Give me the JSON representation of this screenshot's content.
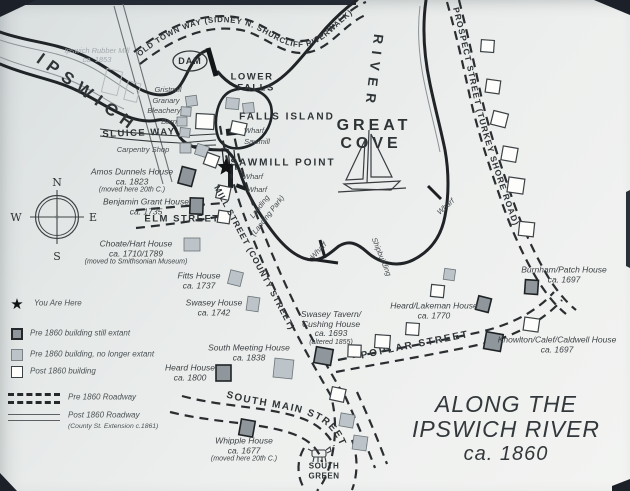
{
  "title": {
    "line1": "ALONG THE",
    "line2": "IPSWICH RIVER",
    "line3": "ca. 1860"
  },
  "waterways": {
    "river_name": "IPSWICH",
    "river_word": "RIVER",
    "cove1": "GREAT",
    "cove2": "COVE",
    "dam": "DAM",
    "falls1": "LOWER",
    "falls2": "FALLS",
    "falls_island": "FALLS ISLAND",
    "sawmill_point": "SAWMILL POINT",
    "sluice_way": "SLUICE WAY"
  },
  "streets": {
    "old_town_way": "OLD TOWN WAY (SIDNEY N. SHURCLIFF RIVERWALK)",
    "prospect": "PROSPECT STREET (TURKEY SHORE ROAD)",
    "elm": "ELM STREET",
    "mill": "MILL STREET (COUNTY STREET)",
    "poplar": "POPLAR STREET",
    "south_main": "SOUTH MAIN STREET",
    "south_green1": "SOUTH",
    "south_green2": "GREEN"
  },
  "sites": {
    "wharf": "Wharf",
    "sawmill": "Sawmill",
    "shipbuilding": "Shipbuilding",
    "landing1": "Landing",
    "landing2": "(Landing Park)",
    "gristmill": "Gristmill",
    "granary": "Granary",
    "bleachery": "Bleachery",
    "barn": "Barn",
    "carpentry_shop": "Carpentry Shop",
    "rubber_mill1": "Ipswich Rubber Mill",
    "rubber_mill2": "ca. 1853"
  },
  "houses": [
    {
      "name": "Amos Dunnels House",
      "date": "ca. 1823",
      "note": "(moved here 20th C.)"
    },
    {
      "name": "Benjamin Grant House",
      "date": "ca. 1735",
      "note": ""
    },
    {
      "name": "Choate/Hart House",
      "date": "ca. 1710/1789",
      "note": "(moved to Smithsonian Museum)"
    },
    {
      "name": "Fitts House",
      "date": "ca. 1737",
      "note": ""
    },
    {
      "name": "Swasey House",
      "date": "ca. 1742",
      "note": ""
    },
    {
      "name": "Swasey Tavern/ Cushing House",
      "date": "ca. 1693",
      "note": "(altered 1855)"
    },
    {
      "name": "South Meeting House",
      "date": "ca. 1838",
      "note": ""
    },
    {
      "name": "Heard House",
      "date": "ca. 1800",
      "note": ""
    },
    {
      "name": "Whipple House",
      "date": "ca. 1677",
      "note": "(moved here 20th C.)"
    },
    {
      "name": "Heard/Lakeman House",
      "date": "ca. 1770",
      "note": ""
    },
    {
      "name": "Burnham/Patch House",
      "date": "ca. 1697",
      "note": ""
    },
    {
      "name": "Knowlton/Calef/Caldwell House",
      "date": "ca. 1697",
      "note": ""
    }
  ],
  "legend": {
    "you_are_here": "You Are Here",
    "extant": "Pre 1860 building still extant",
    "gone": "Pre 1860 building, no longer extant",
    "post": "Post 1860 building",
    "pre_road": "Pre 1860 Roadway",
    "post_road": "Post 1860 Roadway",
    "post_road_note": "(County St. Extension c.1861)"
  },
  "compass": {
    "n": "N",
    "e": "E",
    "s": "S",
    "w": "W"
  },
  "colors": {
    "ink": "#2b2f32",
    "extant_fill": "#8f979c",
    "gone_fill": "#bcc4c9",
    "post_fill": "#fdfdfc"
  }
}
